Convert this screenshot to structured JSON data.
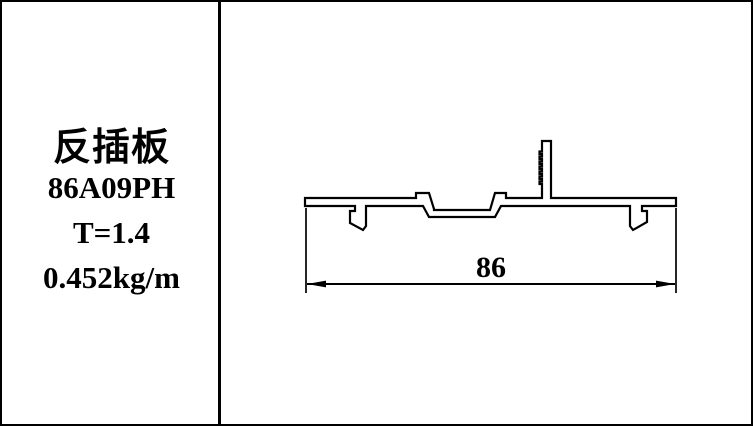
{
  "sheet": {
    "paper_color": "#ffffff",
    "ink_color": "#000000"
  },
  "title_block": {
    "name": "反插板",
    "code": "86A09PH",
    "thickness": "T=1.4",
    "unit_weight": "0.452kg/m"
  },
  "drawing": {
    "type": "profile-cross-section",
    "dimension_width_label": "86"
  }
}
